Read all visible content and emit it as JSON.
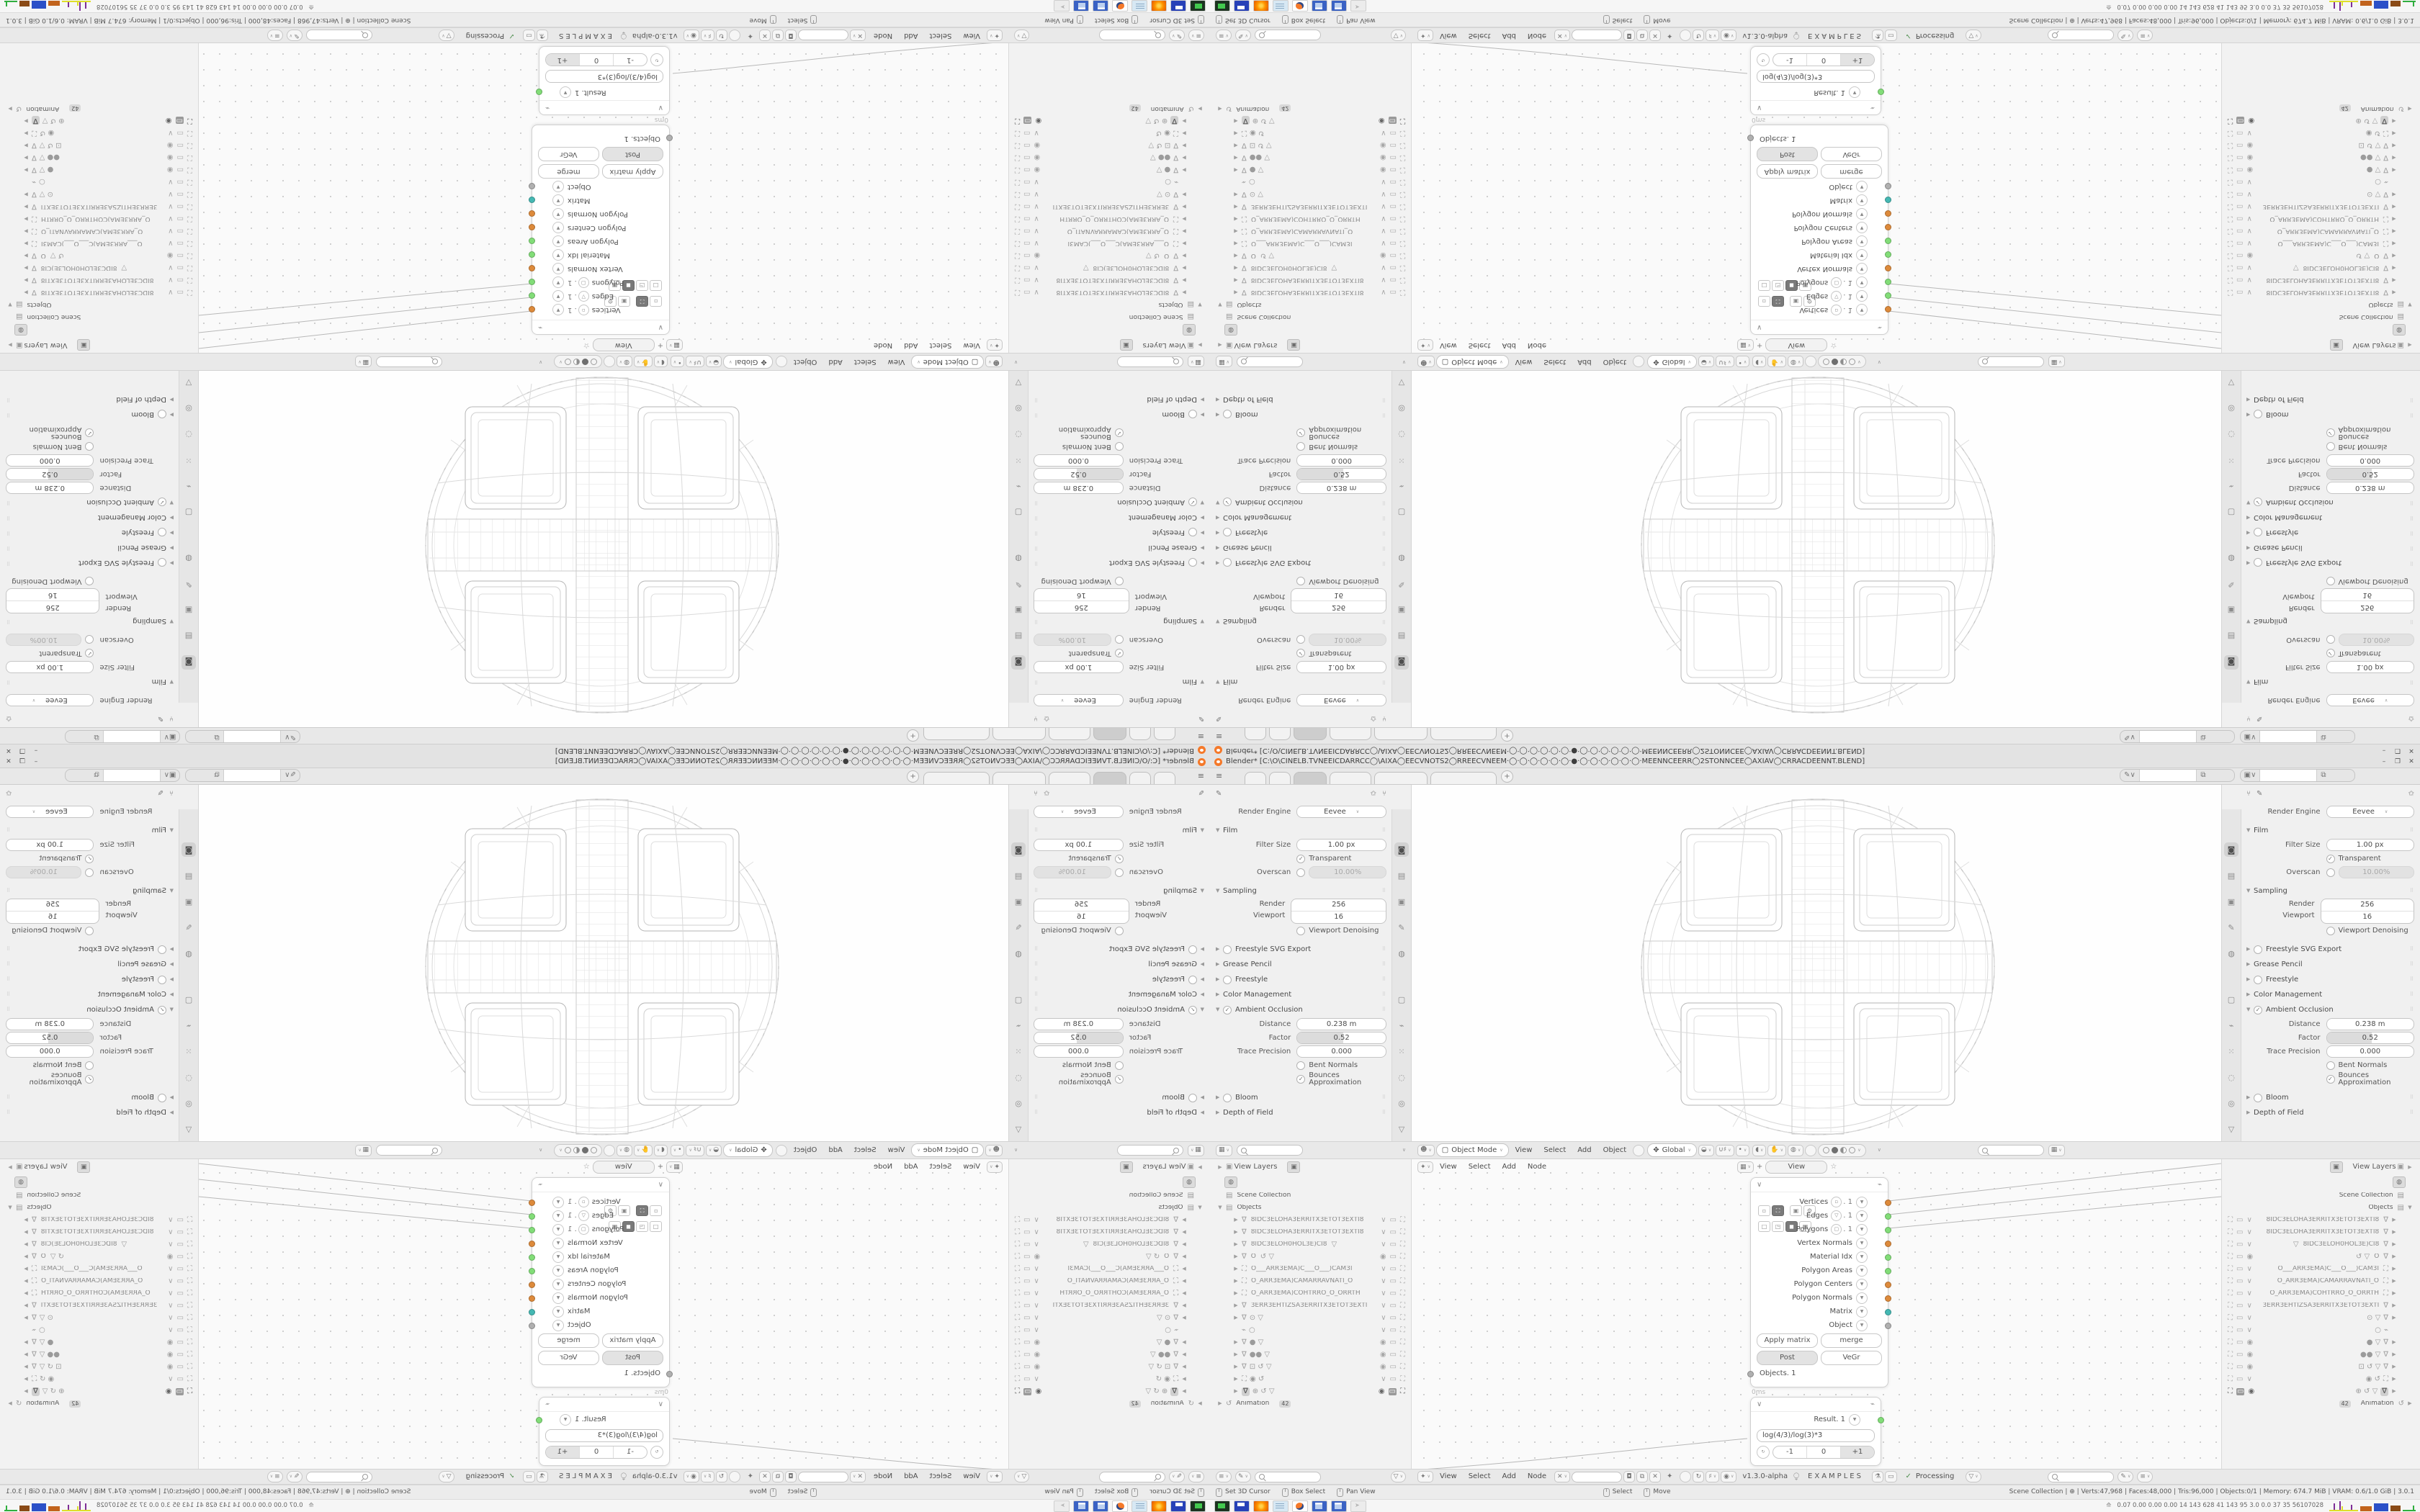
{
  "window": {
    "app_title": "Blender* [C:\\O\\CINELB.TVNEEICDARRCC◯\\AIXA◯EECVNOTS2◯RREECVNEEM·◯·◯·◯·◯·◯·◯·●·◯·◯·◯·◯·◯·◯·MEENNCEERR◯2STONNCEE◯AXIAV◯CRRACDEENNT.BLEND]",
    "minimize": "–",
    "maximize": "❐",
    "close": "✕"
  },
  "props": {
    "engine_label": "Render Engine",
    "engine_value": "Eevee",
    "film_title": "Film",
    "filter_label": "Filter Size",
    "filter_value": "1.00 px",
    "transparent_label": "Transparent",
    "overscan_label": "Overscan",
    "overscan_value": "10.00%",
    "sampling_title": "Sampling",
    "render_label": "Render",
    "render_value": "256",
    "viewport_label": "Viewport",
    "viewport_value": "16",
    "denoise_label": "Viewport Denoising",
    "sec_freestyle_svg": "Freestyle SVG Export",
    "sec_grease": "Grease Pencil",
    "sec_freestyle": "Freestyle",
    "sec_colormgmt": "Color Management",
    "ao_title": "Ambient Occlusion",
    "distance_label": "Distance",
    "distance_value": "0.238 m",
    "factor_label": "Factor",
    "factor_value": "0.52",
    "trace_label": "Trace Precision",
    "trace_value": "0.000",
    "bent_label": "Bent Normals",
    "bounces_label": "Bounces Approximation",
    "sec_bloom": "Bloom",
    "sec_dof": "Depth of Field"
  },
  "viewport": {
    "mode": "Object Mode",
    "menus": [
      "View",
      "Select",
      "Add",
      "Object"
    ],
    "orientation": "Global"
  },
  "node_editor": {
    "menus": [
      "View",
      "Select",
      "Add",
      "Node"
    ],
    "float_tab_plus": "+",
    "float_tab": "View"
  },
  "node_mesh": {
    "outputs": [
      {
        "label": "Vertices",
        "suffix": ". 1"
      },
      {
        "label": "Edges",
        "suffix": ". 1"
      },
      {
        "label": "Polygons",
        "suffix": ". 1"
      },
      {
        "label": "Vertex Normals"
      },
      {
        "label": "Material Idx"
      },
      {
        "label": "Polygon Areas"
      },
      {
        "label": "Polygon Centers"
      },
      {
        "label": "Polygon Normals"
      },
      {
        "label": "Matrix"
      },
      {
        "label": "Object"
      }
    ],
    "btn_apply": "Apply matrix",
    "btn_merge": "merge",
    "btn_post": "Post",
    "btn_vegr": "VeGr",
    "input_label": "Objects. 1",
    "time": "0ms"
  },
  "node_result": {
    "output_label": "Result. 1",
    "expression": "log(4/3)/log(3)*3",
    "btn_minus": "-1",
    "btn_zero": "0",
    "btn_plus": "+1"
  },
  "outliner": {
    "view_layers": "View Layers",
    "scene_collection": "Scene Collection",
    "objects": "Objects",
    "animation": "Animation",
    "animation_badge": "42",
    "items": [
      {
        "name": "8IDC3ELOHA3ERRITX3ETOT3EXTI8",
        "extra": ""
      },
      {
        "name": "8IDC3ELOHA3ERRITX3ETOT3EXTI8",
        "extra": ""
      },
      {
        "name": "8IDC3ELOH0HOL3E)CI8",
        "extra": "▽"
      },
      {
        "name": "O",
        "extra": "↺ ▽"
      },
      {
        "name": "O___ARR3EMA)C___O___)CAM3I",
        "extra": ""
      },
      {
        "name": "O_ARR3EMA)CAMARRAVNATI_O",
        "extra": ""
      },
      {
        "name": "O_ARR3EMA)COHTRRO_O_ORRTH",
        "extra": ""
      },
      {
        "name": "3ERR3EHTIZSA3ERRITX3ETOT3EXTI",
        "extra": ""
      },
      {
        "name": "",
        "extra": "⊙ ▽"
      },
      {
        "name": "",
        "extra": "○"
      },
      {
        "name": "",
        "extra": "● ▽"
      },
      {
        "name": "",
        "extra": "●● ▽"
      },
      {
        "name": "",
        "extra": "⊡ ↺ ▽"
      },
      {
        "name": "",
        "extra": "◉ ↺"
      },
      {
        "name": "",
        "extra": "⊕ ↺ ▽"
      }
    ]
  },
  "footer": {
    "version": "v1.3.0-alpha",
    "project": "EXAMPLES",
    "status": "Processing"
  },
  "statusbar": {
    "hint1": "Set 3D Cursor",
    "hint2": "Box Select",
    "hint3": "Pan View",
    "hint4": "Select",
    "hint5": "Move",
    "stats": "Scene Collection  |  ⊕  |  Verts:47,968  |  Faces:48,000  |  Tris:96,000  |  Objects:0/1  |  Memory: 674.7 MiB  |  VRAM: 0.6/1.0 GiB  |  3.0.1"
  },
  "taskbar": {
    "sysmon": "0.07 0.00 0.00 0.00    14    143    628    41    143    95    3.0    0.0    37    35    56107028"
  },
  "colors": {
    "socket_orange": "#dd8a3b",
    "socket_green": "#82dd78",
    "socket_teal": "#45b8b3",
    "socket_gray": "#b0b0b0",
    "ui_bg": "#f0f0f0",
    "strip_bg": "#e9e9e9"
  }
}
